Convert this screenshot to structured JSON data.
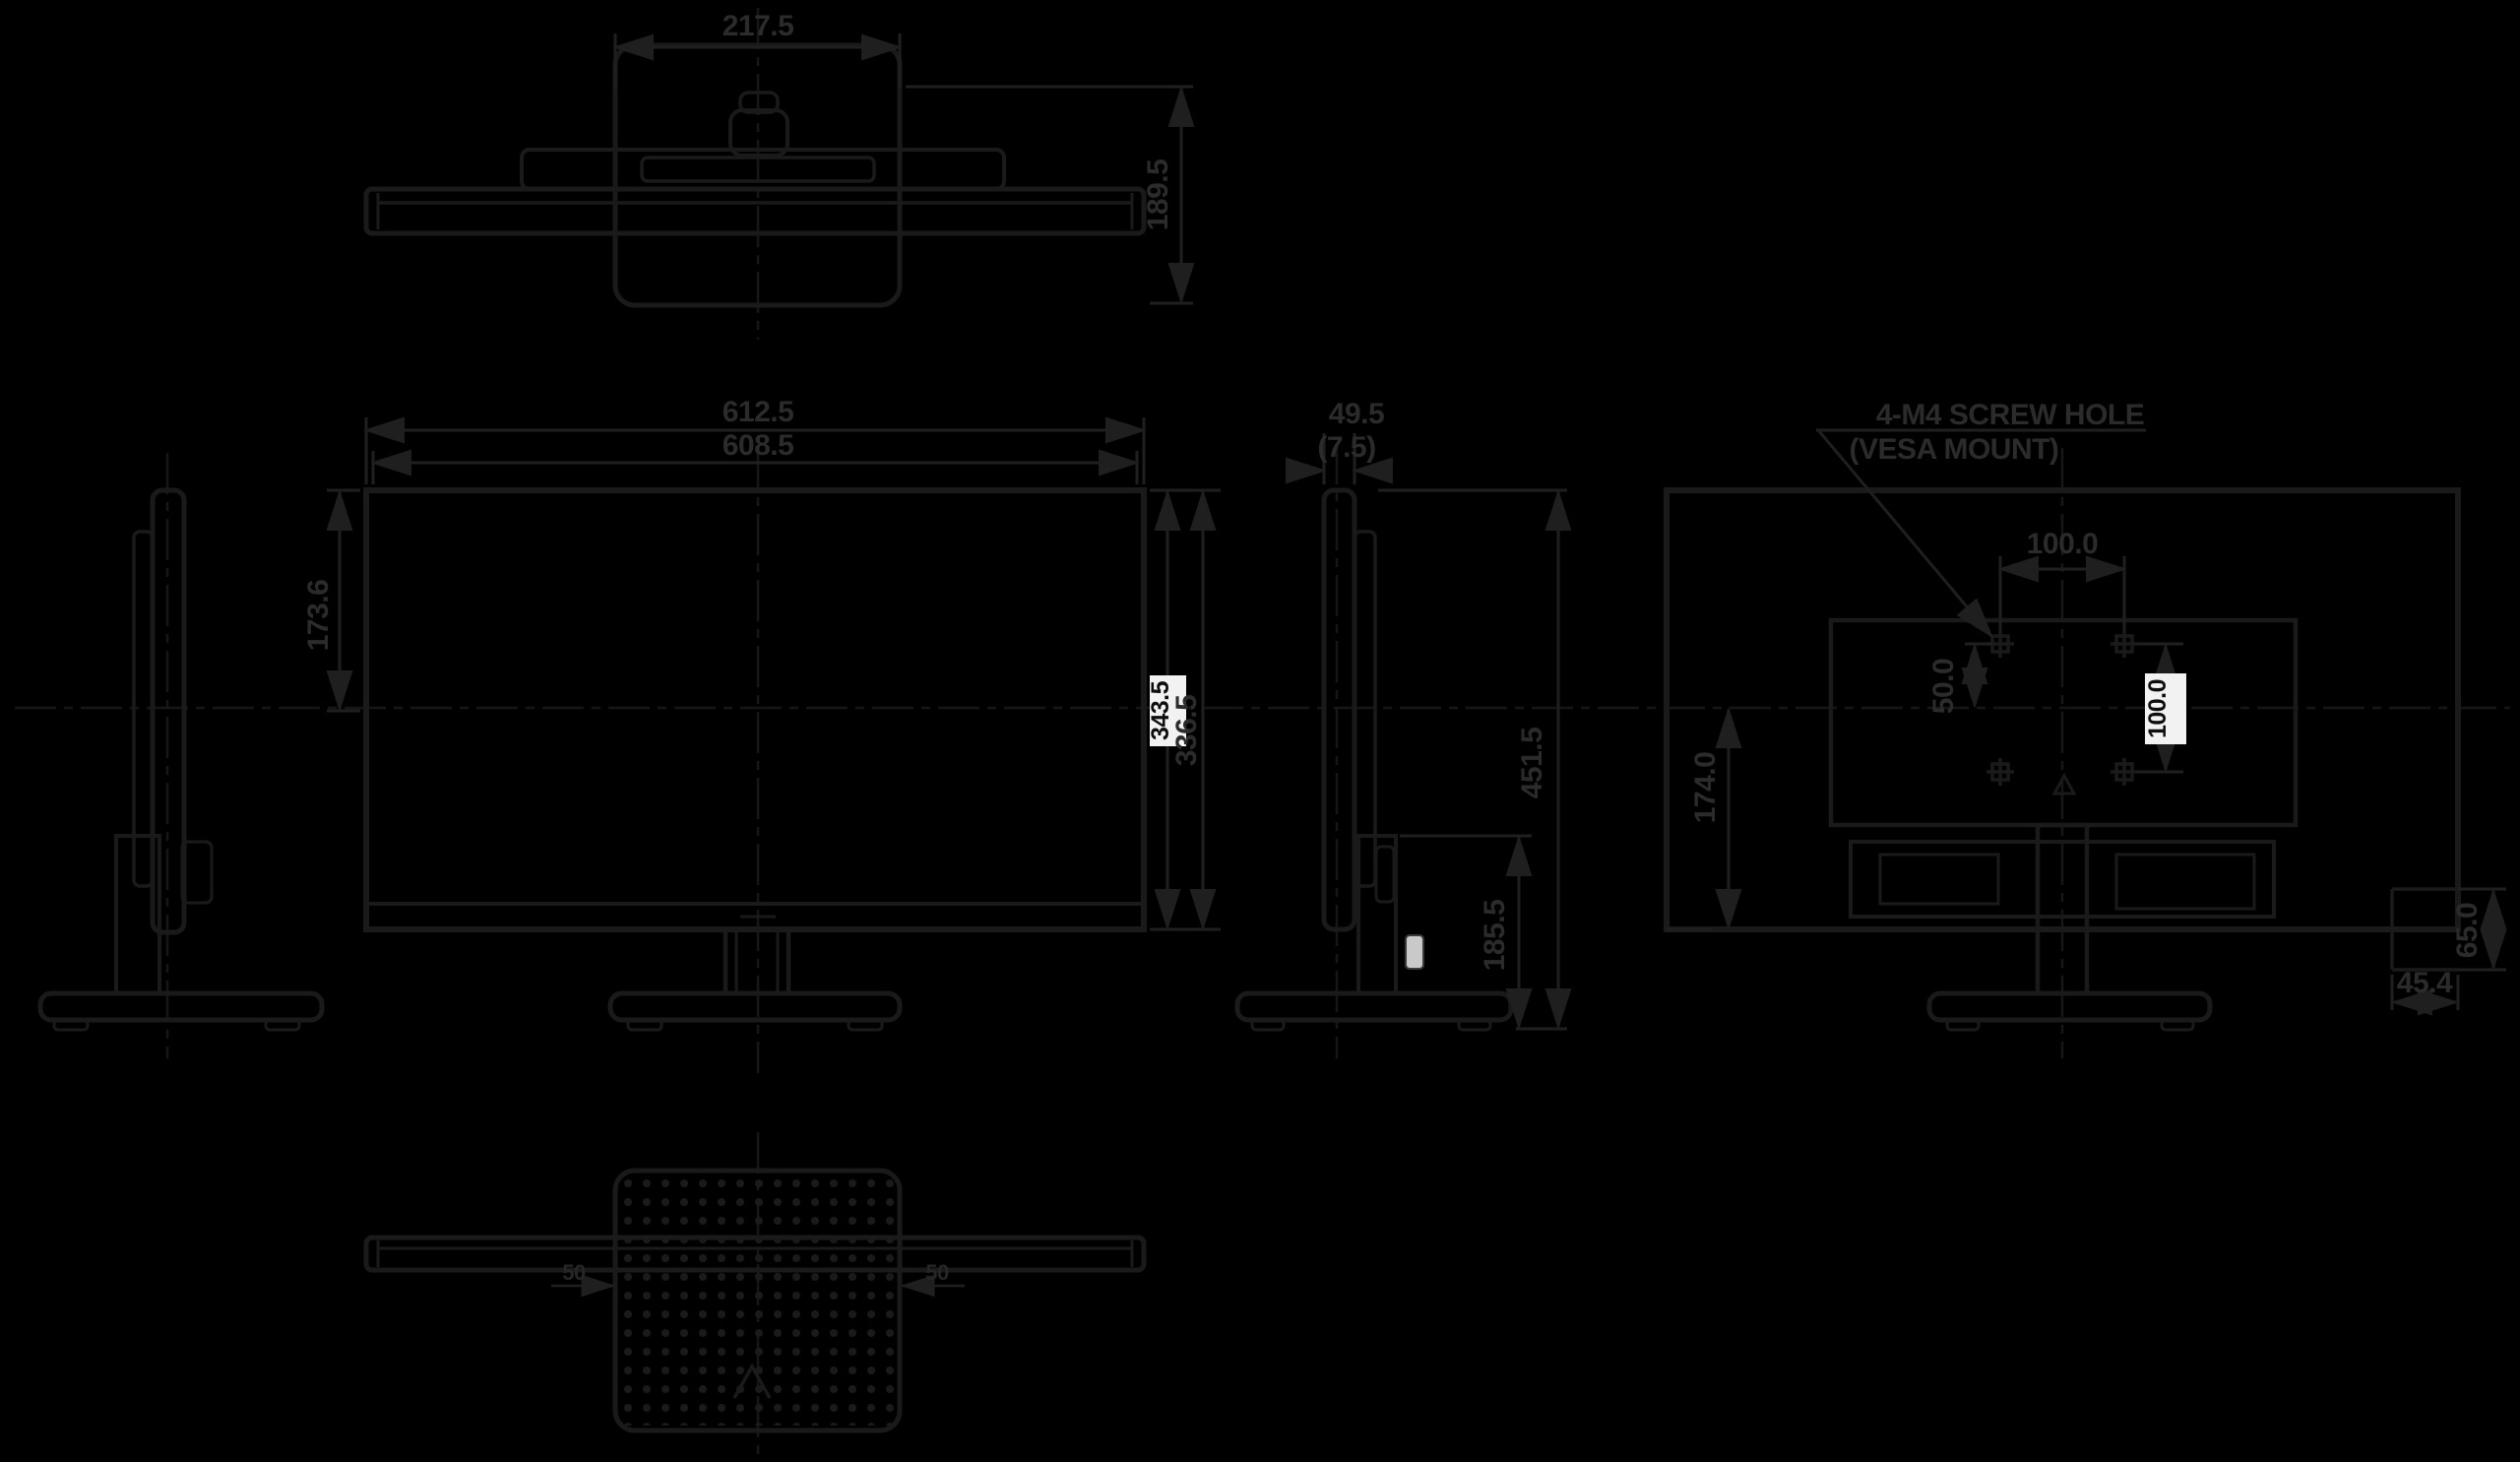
{
  "drawing": {
    "type": "monitor-dimensional-drawing",
    "colors": {
      "background": "#000000",
      "line": "#1a1a1a",
      "dim_line": "#191919",
      "text": "#2b2b2b",
      "highlight_box_bg": "#f2f2f2",
      "highlight_box_text": "#0e0e0e"
    },
    "views": {
      "top": {
        "dims": {
          "base_width": "217.5",
          "depth": "189.5"
        }
      },
      "front": {
        "dims": {
          "outer_width": "612.5",
          "inner_width": "608.5",
          "upper_height": "173.6",
          "height_boxed": "343.5",
          "height_secondary": "336.5"
        }
      },
      "side": {
        "dims": {
          "thickness": "49.5",
          "bezel": "(7.5)",
          "total_height": "451.5",
          "stand_height": "185.5"
        }
      },
      "rear": {
        "note_line1": "4-M4 SCREW HOLE",
        "note_line2": "(VESA MOUNT)",
        "dims": {
          "vesa_horizontal": "100.0",
          "vesa_vertical_boxed": "100.0",
          "vesa_offset": "50.0",
          "lower_height": "174.0",
          "corner_vertical": "65.0",
          "corner_horizontal": "45.4"
        }
      },
      "bottom": {
        "dims": {
          "left": "50",
          "right": "50"
        }
      }
    }
  }
}
